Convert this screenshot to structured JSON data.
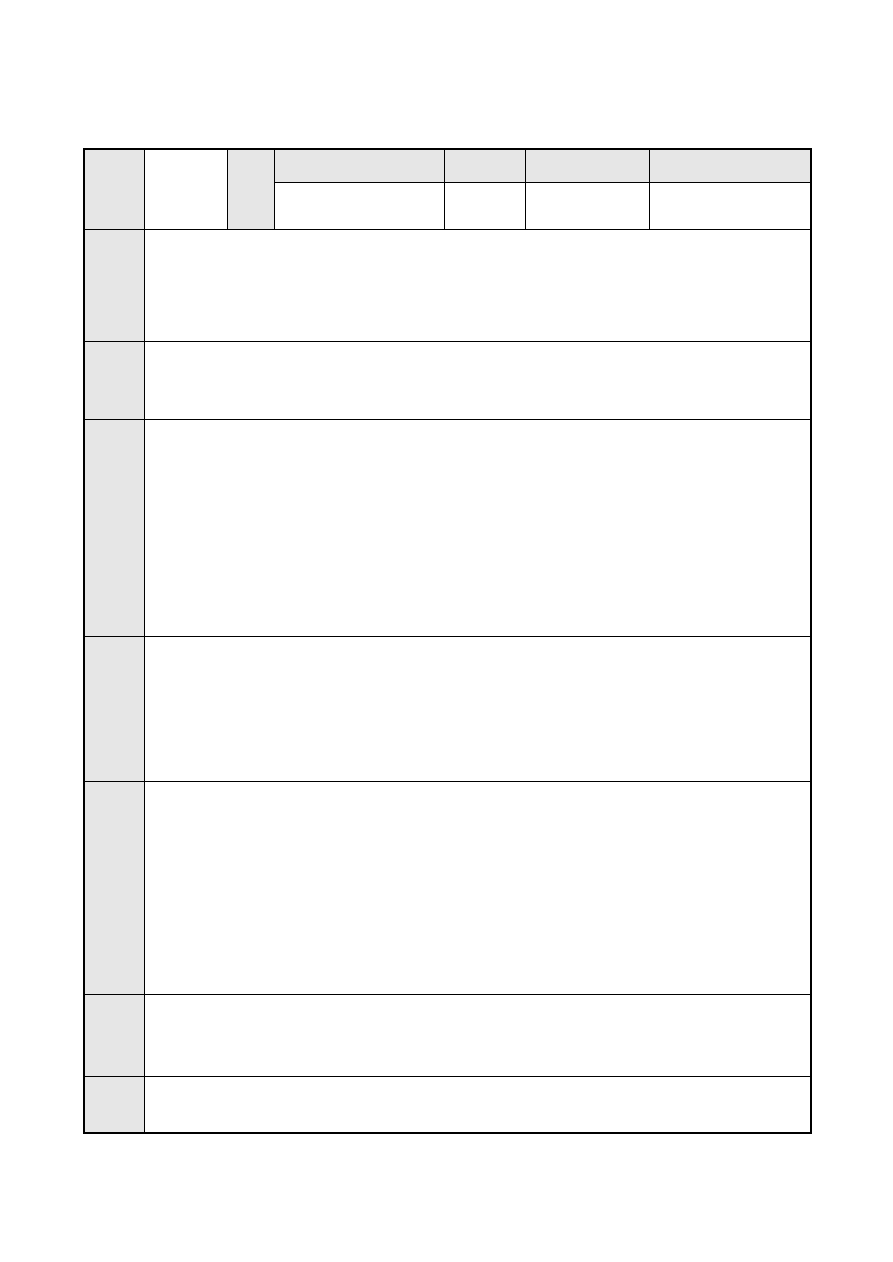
{
  "page": {
    "background_color": "#ffffff"
  },
  "table": {
    "border_color": "#000000",
    "header_fill_color": "#e6e6e6",
    "cell_background_color": "#ffffff",
    "header": {
      "label_column": "",
      "col2": "",
      "col3": "",
      "group_cols": [
        "",
        "",
        "",
        ""
      ],
      "sub_cols": [
        "",
        "",
        "",
        ""
      ]
    },
    "rows": [
      {
        "label": "",
        "content": ""
      },
      {
        "label": "",
        "content": ""
      },
      {
        "label": "",
        "content": ""
      },
      {
        "label": "",
        "content": ""
      },
      {
        "label": "",
        "content": ""
      },
      {
        "label": "",
        "content": ""
      },
      {
        "label": "",
        "content": ""
      }
    ]
  }
}
